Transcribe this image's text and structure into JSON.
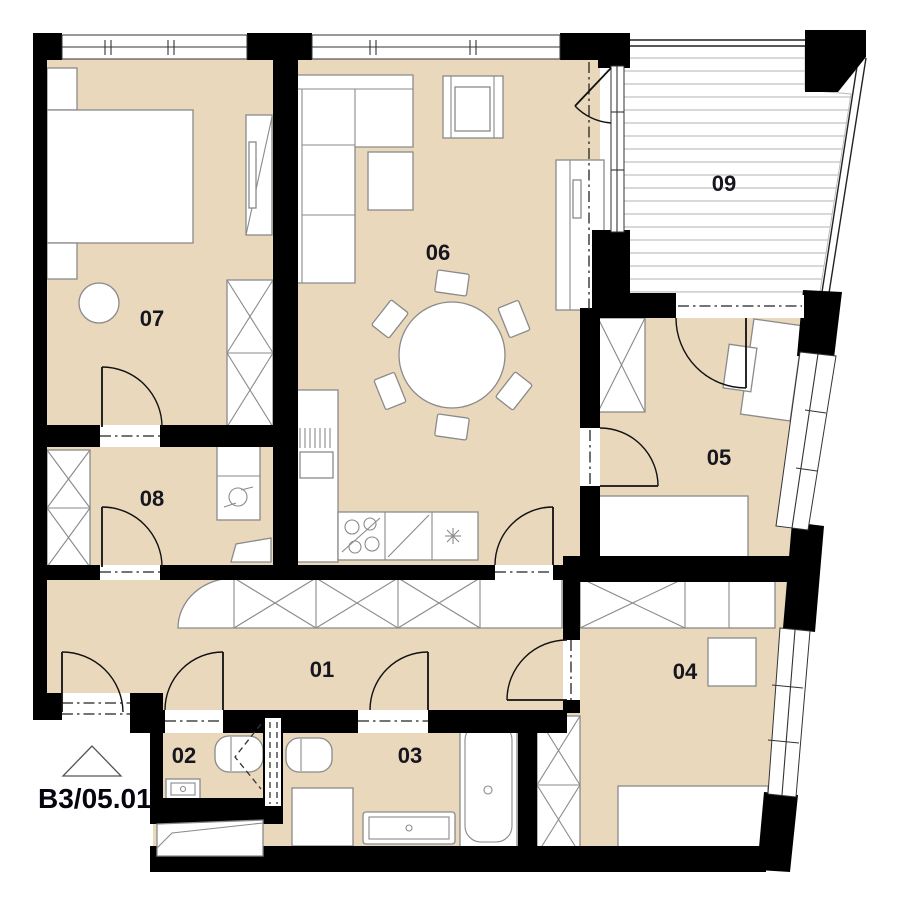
{
  "plan": {
    "unit_label": "B3/05.01",
    "colors": {
      "floor": "#e9d8bc",
      "wall": "#000000",
      "stroke": "#8a8a8a",
      "label": "#16161e",
      "deck": "#c9c9c9"
    },
    "rooms": [
      {
        "id": "01",
        "label": "01"
      },
      {
        "id": "02",
        "label": "02"
      },
      {
        "id": "03",
        "label": "03"
      },
      {
        "id": "04",
        "label": "04"
      },
      {
        "id": "05",
        "label": "05"
      },
      {
        "id": "06",
        "label": "06"
      },
      {
        "id": "07",
        "label": "07"
      },
      {
        "id": "08",
        "label": "08"
      },
      {
        "id": "09",
        "label": "09"
      }
    ]
  }
}
